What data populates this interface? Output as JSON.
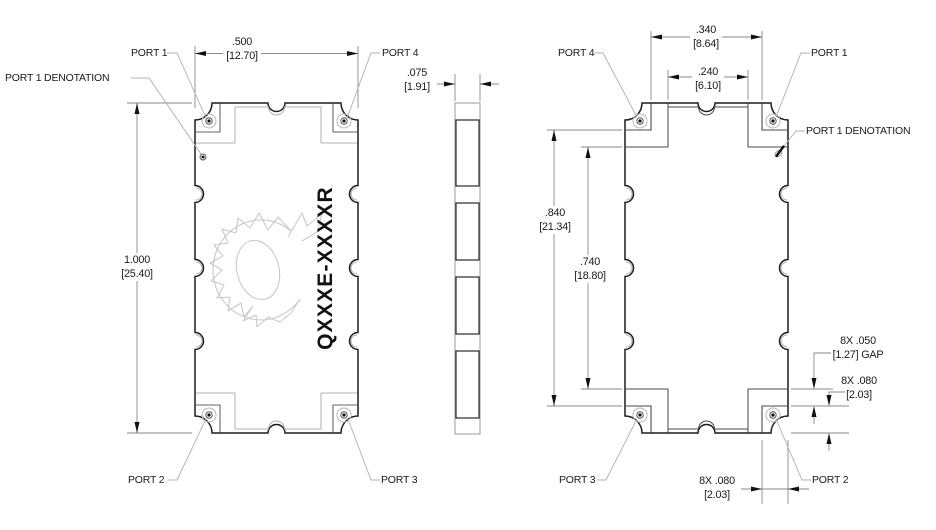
{
  "part_marking": "QXXXE-XXXXR",
  "views": {
    "top_view": {
      "ports": {
        "top_left": "PORT 1",
        "top_right": "PORT 4",
        "bottom_left": "PORT 2",
        "bottom_right": "PORT 3"
      },
      "denotation_label": "PORT 1 DENOTATION"
    },
    "bottom_view": {
      "ports": {
        "top_left": "PORT 4",
        "top_right": "PORT 1",
        "bottom_left": "PORT 3",
        "bottom_right": "PORT 2"
      },
      "denotation_label": "PORT 1 DENOTATION"
    }
  },
  "dimensions": {
    "body_width": {
      "inches": ".500",
      "mm": "[12.70]"
    },
    "body_height": {
      "inches": "1.000",
      "mm": "[25.40]"
    },
    "thickness": {
      "inches": ".075",
      "mm": "[1.91]"
    },
    "pad_outer_span": {
      "inches": ".340",
      "mm": "[8.64]"
    },
    "pad_inner_span": {
      "inches": ".240",
      "mm": "[6.10]"
    },
    "pad_outer_height": {
      "inches": ".840",
      "mm": "[21.34]"
    },
    "pad_inner_height": {
      "inches": ".740",
      "mm": "[18.80]"
    },
    "pad_gap": {
      "inches": "8X .050",
      "mm": "[1.27] GAP"
    },
    "pad_height": {
      "inches": "8X .080",
      "mm": "[2.03]"
    },
    "pad_width": {
      "inches": "8X .080",
      "mm": "[2.03]"
    }
  },
  "colors": {
    "outline": "#1c1c1c",
    "secondary_lines": "#4a4a4a",
    "hidden_lines": "#b0b0b0",
    "dimension_lines": "#8a8a8a",
    "logo": "#c9c9c9",
    "background": "#ffffff"
  }
}
